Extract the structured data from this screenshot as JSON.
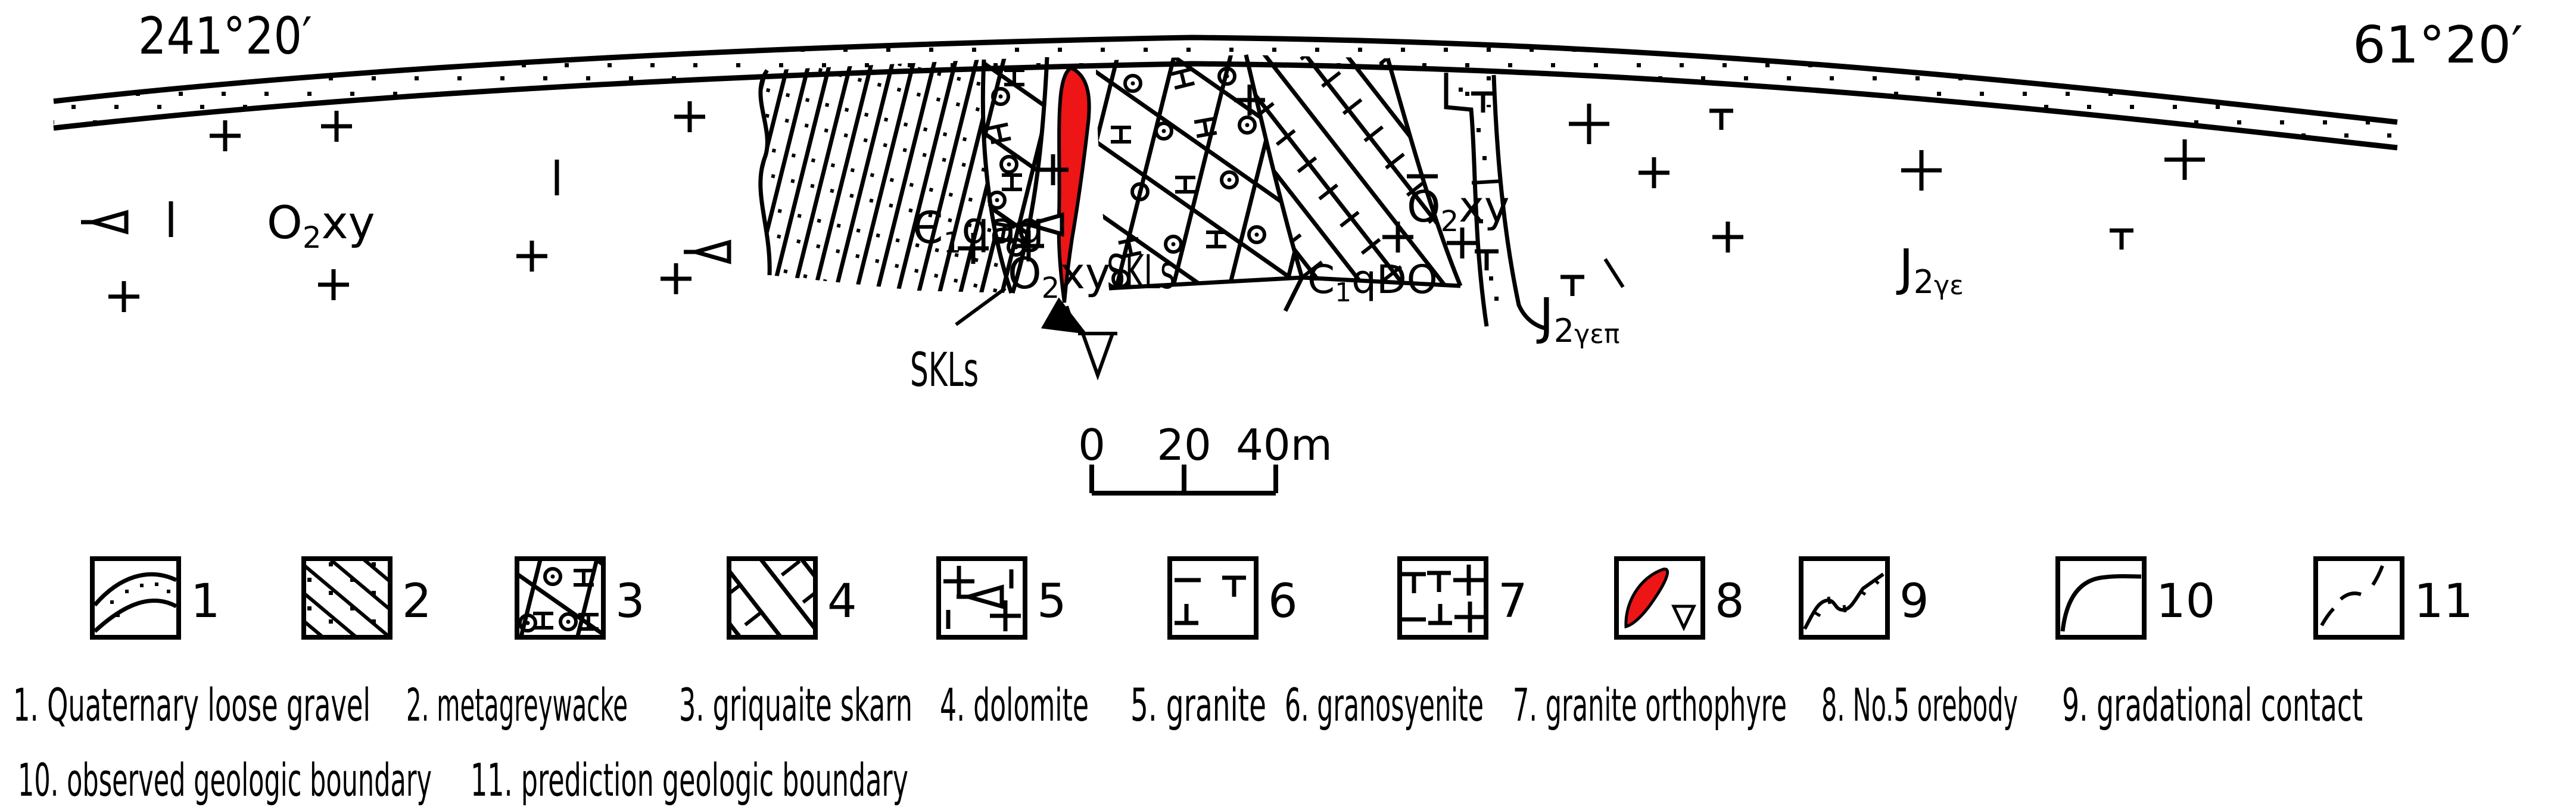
{
  "figure": {
    "bearing_left": "241°20′",
    "bearing_right": "61°20′"
  },
  "map_labels": {
    "o2xy_left": {
      "base": "O",
      "sub": "2",
      "rest": "xy"
    },
    "e1qag": {
      "base": "Є",
      "sub": "1",
      "rest": "qag"
    },
    "skls_left": "SKLs",
    "o2xy_center": {
      "base": "O",
      "sub": "2",
      "rest": "xy"
    },
    "skls_center": "SKLs",
    "e1qdo": {
      "base": "Є",
      "sub": "1",
      "rest": "qDO"
    },
    "o2xy_overbar": {
      "base": "O",
      "sub": "2",
      "rest": "xy"
    },
    "j2_gamma_epsilon_pi": {
      "base": "J",
      "sub": "2",
      "rest": "γεπ"
    },
    "j2_gamma_epsilon": {
      "base": "J",
      "sub": "2",
      "rest": "γε"
    }
  },
  "scale_bar": {
    "tick0": "0",
    "tick20": "20",
    "tick40": "40m"
  },
  "legend": {
    "numbers": [
      "1",
      "2",
      "3",
      "4",
      "5",
      "6",
      "7",
      "8",
      "9",
      "10",
      "11"
    ],
    "captions_row1": [
      "1. Quaternary loose gravel",
      "2. metagreywacke",
      "3. griquaite skarn",
      "4. dolomite",
      "5. granite",
      "6. granosyenite",
      "7. granite orthophyre",
      "8. No.5 orebody",
      "9. gradational contact"
    ],
    "captions_row2": [
      "10. observed geologic boundary",
      "11. prediction geologic boundary"
    ]
  },
  "colors": {
    "orebody_red": "#ed1515",
    "ink": "#000000",
    "paper": "#ffffff"
  }
}
